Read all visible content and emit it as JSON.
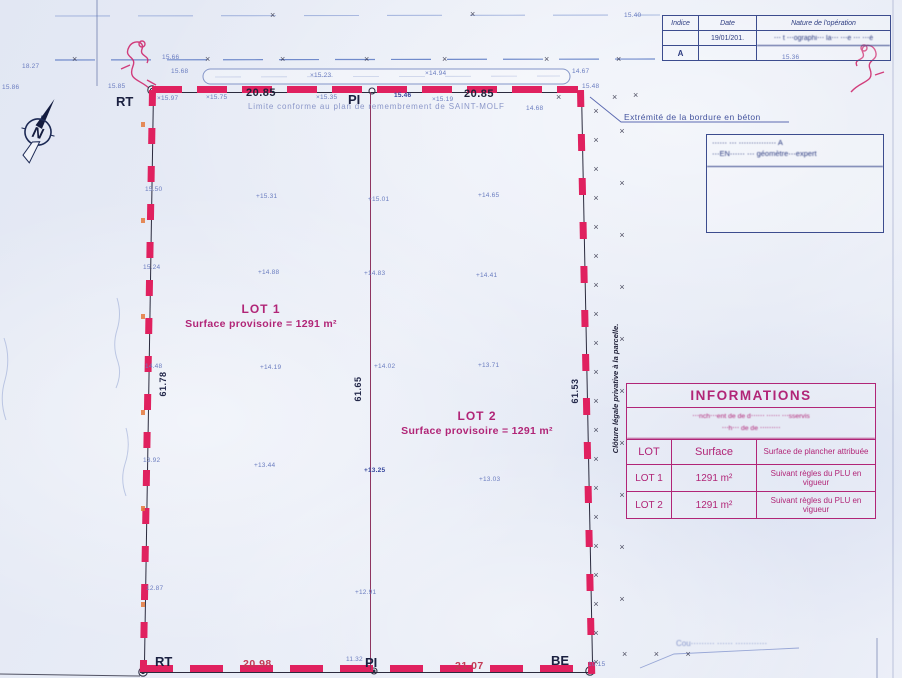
{
  "north": {
    "letter": "N"
  },
  "glyphs": {
    "x_mark": "×",
    "fence_col_1": "××××××××××××××××××××",
    "fence_col_2": "××××××××××",
    "fence_row_bottom": "× × ×"
  },
  "revision_table": {
    "headers": [
      "Indice",
      "Date",
      "Nature de l'opération"
    ],
    "rows": [
      {
        "indice": "",
        "date": "19/01/201.",
        "nature": "⋯ t  ⋯ographi⋯    la⋯    ⋯e ⋯    ⋯é"
      },
      {
        "indice": "A",
        "date": "",
        "nature": ""
      }
    ]
  },
  "cartouche": {
    "line1": "⋯⋯ ⋯ ⋯⋯⋯⋯⋯ A",
    "line2": "⋯EN⋯⋯ ⋯  géomètre⋯expert"
  },
  "notes": {
    "limite": "Limite conforme au plan de remembrement de SAINT-MOLF",
    "extremite": "Extrémité de la bordure en béton",
    "cloture": "Clôture légale privative à la parcelle.",
    "bottom_right": "Cou⋯⋯⋯ ⋯⋯ ⋯⋯⋯⋯"
  },
  "lots": [
    {
      "name": "LOT 1",
      "surface_line": "Surface provisoire = 1291 m²"
    },
    {
      "name": "LOT 2",
      "surface_line": "Surface provisoire = 1291 m²"
    }
  ],
  "points": {
    "rt_top": "RT",
    "pi_top": "PI",
    "rt_bottom": "RT",
    "pi_bottom": "PI",
    "be_bottom": "BE"
  },
  "dimensions": {
    "top_left": "20.85",
    "top_right": "20.85",
    "bottom_left": "20.98",
    "bottom_right": "21.07",
    "left_side": "61.78",
    "middle": "61.65",
    "right_side": "61.53"
  },
  "info_table": {
    "title": "INFORMATIONS",
    "note_line1": "⋯nch⋯ent de de d⋯⋯ ⋯⋯ ⋯sservis",
    "note_line2": "⋯h⋯ de de ⋯⋯⋯",
    "headers": [
      "LOT",
      "Surface",
      "Surface de plancher attribuée"
    ],
    "rows": [
      [
        "LOT 1",
        "1291 m²",
        "Suivant règles du PLU en vigueur"
      ],
      [
        "LOT 2",
        "1291 m²",
        "Suivant règles du PLU en vigueur"
      ]
    ]
  },
  "colors": {
    "boundary_red": "#e0215f",
    "magenta_text": "#b12577",
    "navy": "#2d3c80",
    "elevation_blue": "#6b7dc0"
  },
  "elevations": [
    "15.86",
    "18.27",
    "15.66",
    "15.68",
    "15.85",
    "×15.23",
    "×14.94",
    "14.67",
    "15.40",
    "15.36",
    "×15.97",
    "×15.75",
    "×15.35",
    "15.46",
    "×15.19",
    "14.68",
    "15.48",
    "15.50",
    "+15.31",
    "+15.01",
    "+14.65",
    "15.24",
    "+14.88",
    "+14.83",
    "+14.41",
    "14.48",
    "+14.19",
    "+14.02",
    "+13.71",
    "13.92",
    "+13.44",
    "+13.25",
    "+13.03",
    "12.87",
    "+12.91",
    "11.32",
    "10.15"
  ]
}
